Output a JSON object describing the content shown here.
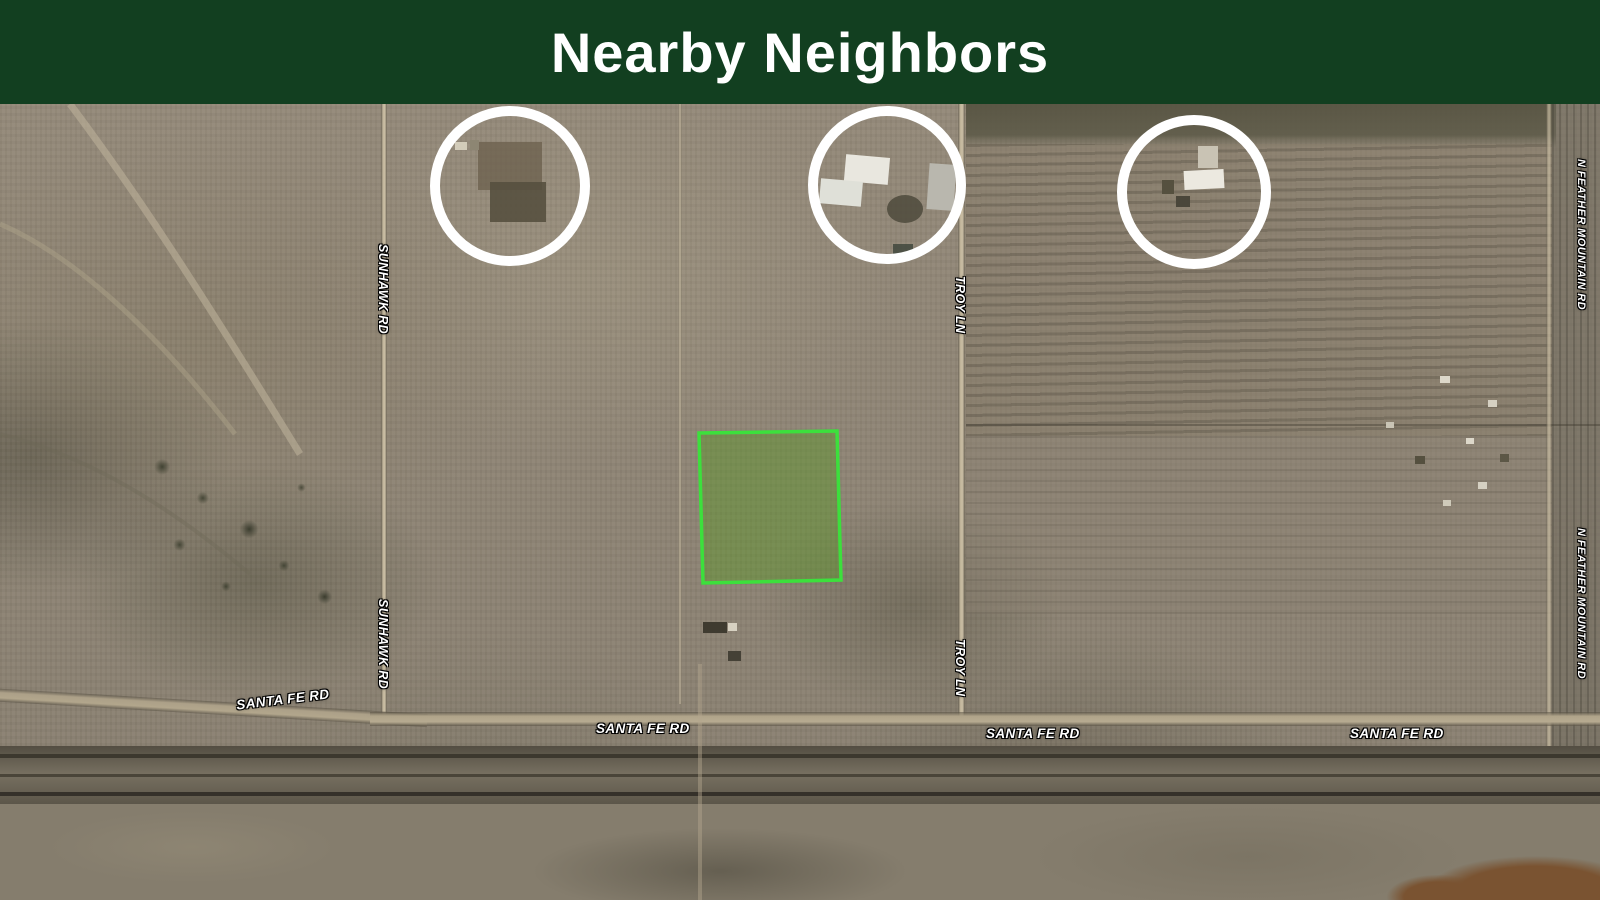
{
  "banner": {
    "title": "Nearby Neighbors",
    "background_color": "#123f20",
    "text_color": "#ffffff"
  },
  "map": {
    "kind": "satellite-aerial-view",
    "road_labels": [
      {
        "id": "sunhawk-rd-north",
        "text": "SUNHAWK RD",
        "orientation": "vertical"
      },
      {
        "id": "sunhawk-rd-south",
        "text": "SUNHAWK RD",
        "orientation": "vertical"
      },
      {
        "id": "troy-ln-north",
        "text": "TROY LN",
        "orientation": "vertical"
      },
      {
        "id": "troy-ln-south",
        "text": "TROY LN",
        "orientation": "vertical"
      },
      {
        "id": "n-feather-mountain-rd-north",
        "text": "N FEATHER MOUNTAIN RD",
        "orientation": "vertical"
      },
      {
        "id": "n-feather-mountain-rd-south",
        "text": "N FEATHER MOUNTAIN RD",
        "orientation": "vertical"
      },
      {
        "id": "santa-fe-rd-west",
        "text": "SANTA FE RD",
        "orientation": "horizontal"
      },
      {
        "id": "santa-fe-rd-center",
        "text": "SANTA FE RD",
        "orientation": "horizontal"
      },
      {
        "id": "santa-fe-rd-east-center",
        "text": "SANTA FE RD",
        "orientation": "horizontal"
      },
      {
        "id": "santa-fe-rd-east",
        "text": "SANTA FE RD",
        "orientation": "horizontal"
      }
    ],
    "annotations": {
      "neighbor_circles": [
        {
          "label": "neighbor-property-1",
          "cx": 510,
          "cy": 82,
          "r": 75,
          "stroke_color": "#ffffff"
        },
        {
          "label": "neighbor-property-2",
          "cx": 887,
          "cy": 81,
          "r": 74,
          "stroke_color": "#ffffff"
        },
        {
          "label": "neighbor-property-3",
          "cx": 1194,
          "cy": 88,
          "r": 72,
          "stroke_color": "#ffffff"
        }
      ],
      "subject_parcel": {
        "stroke_color": "#3ce03c",
        "fill_color": "rgba(90,150,40,0.45)"
      }
    }
  }
}
